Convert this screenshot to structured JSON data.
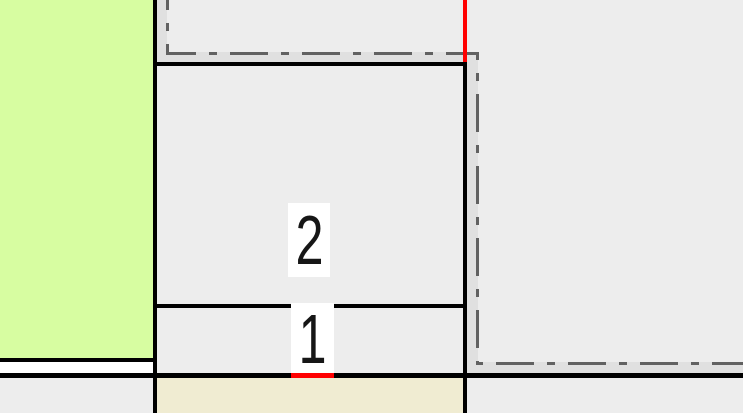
{
  "map": {
    "parcels": [
      {
        "label": "2"
      },
      {
        "label": "1"
      }
    ]
  },
  "colors": {
    "base-gray": "#ededed",
    "band-gray": "#e0e0e0",
    "green": "#d7fda1",
    "beige": "#f0ecd2",
    "road-white": "#ffffff",
    "line-black": "#000000",
    "dashdot-gray": "#616161",
    "red": "#ff0000",
    "label-bg": "#ffffff",
    "label-text": "#161616"
  }
}
